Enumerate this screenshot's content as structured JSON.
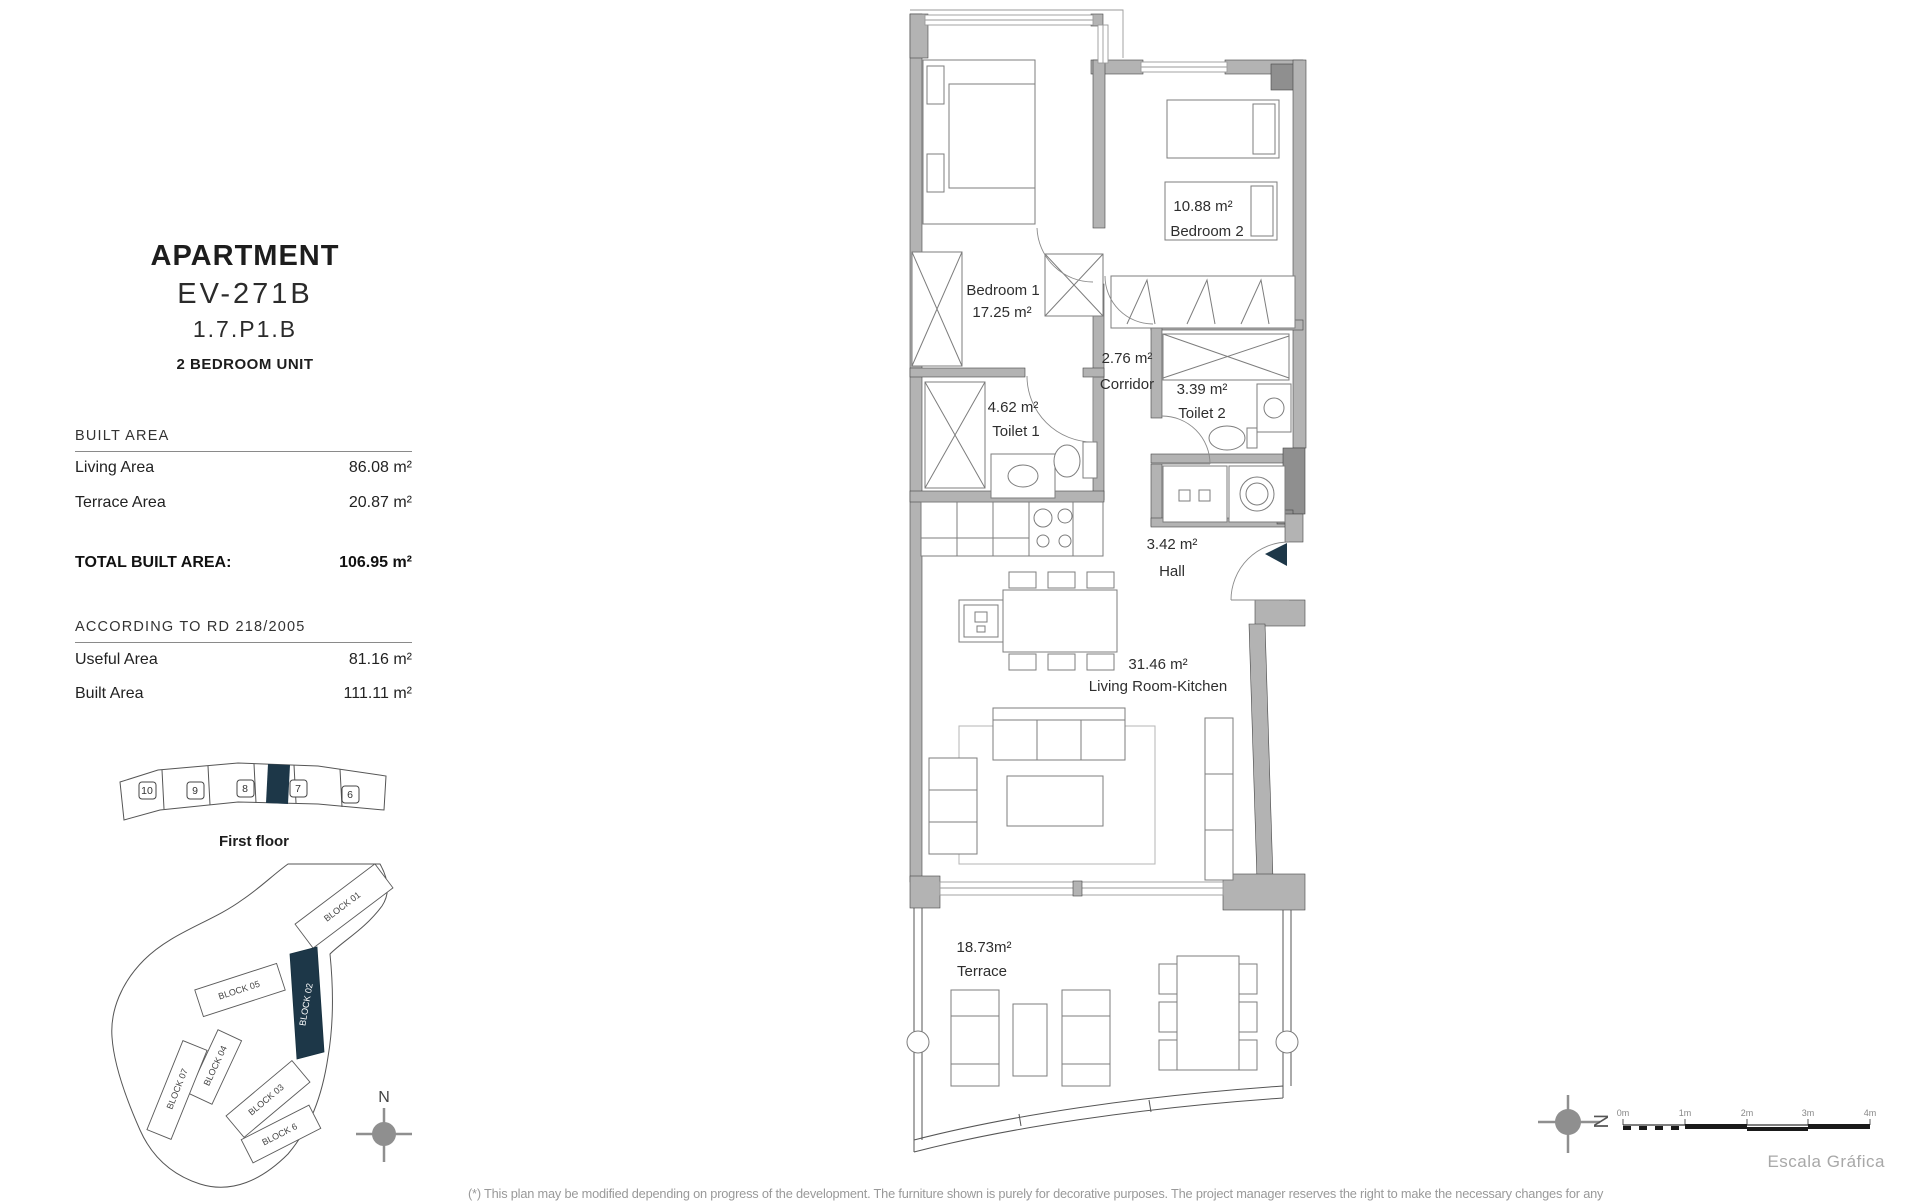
{
  "title_block": {
    "title": "APARTMENT",
    "code": "EV-271B",
    "ref": "1.7.P1.B",
    "subtitle": "2 BEDROOM UNIT"
  },
  "built_area": {
    "header": "BUILT AREA",
    "rows": [
      {
        "label": "Living Area",
        "value": "86.08 m²"
      },
      {
        "label": "Terrace Area",
        "value": "20.87 m²"
      }
    ],
    "total_label": "TOTAL BUILT AREA:",
    "total_value": "106.95 m²"
  },
  "rd_section": {
    "header": "ACCORDING TO RD 218/2005",
    "rows": [
      {
        "label": "Useful Area",
        "value": "81.16 m²"
      },
      {
        "label": "Built Area",
        "value": "111.11 m²"
      }
    ]
  },
  "floor_strip": {
    "caption": "First floor",
    "units": [
      "10",
      "9",
      "8",
      "7",
      "6"
    ]
  },
  "site_plan": {
    "blocks": [
      "BLOCK 01",
      "BLOCK 02",
      "BLOCK 05",
      "BLOCK 04",
      "BLOCK 03",
      "BLOCK 07",
      "BLOCK 6"
    ],
    "north": "N"
  },
  "rooms": {
    "bedroom1": {
      "line1": "Bedroom 1",
      "line2": "17.25 m²"
    },
    "bedroom2": {
      "line1": "10.88 m²",
      "line2": "Bedroom 2"
    },
    "corridor": {
      "line1": "2.76 m²",
      "line2": "Corridor"
    },
    "toilet1": {
      "line1": "4.62 m²",
      "line2": "Toilet 1"
    },
    "toilet2": {
      "line1": "3.39 m²",
      "line2": "Toilet 2"
    },
    "hall": {
      "line1": "3.42 m²",
      "line2": "Hall"
    },
    "living": {
      "line1": "31.46 m²",
      "line2": "Living Room-Kitchen"
    },
    "terrace": {
      "line1": "18.73m²",
      "line2": "Terrace"
    }
  },
  "scale_bar": {
    "ticks": [
      "0m",
      "1m",
      "2m",
      "3m",
      "4m"
    ],
    "caption": "Escala Gráfica",
    "north": "N"
  },
  "footer": {
    "disclaimer": "(*) This plan may be modified depending on progress of the development. The furniture shown is purely for decorative purposes. The project manager reserves the right to make the necessary changes for any"
  },
  "colors": {
    "accent": "#1d3748",
    "wall": "#b3b3b3",
    "wall_dark": "#8f8f8f",
    "compass": "#8f8f8f"
  }
}
